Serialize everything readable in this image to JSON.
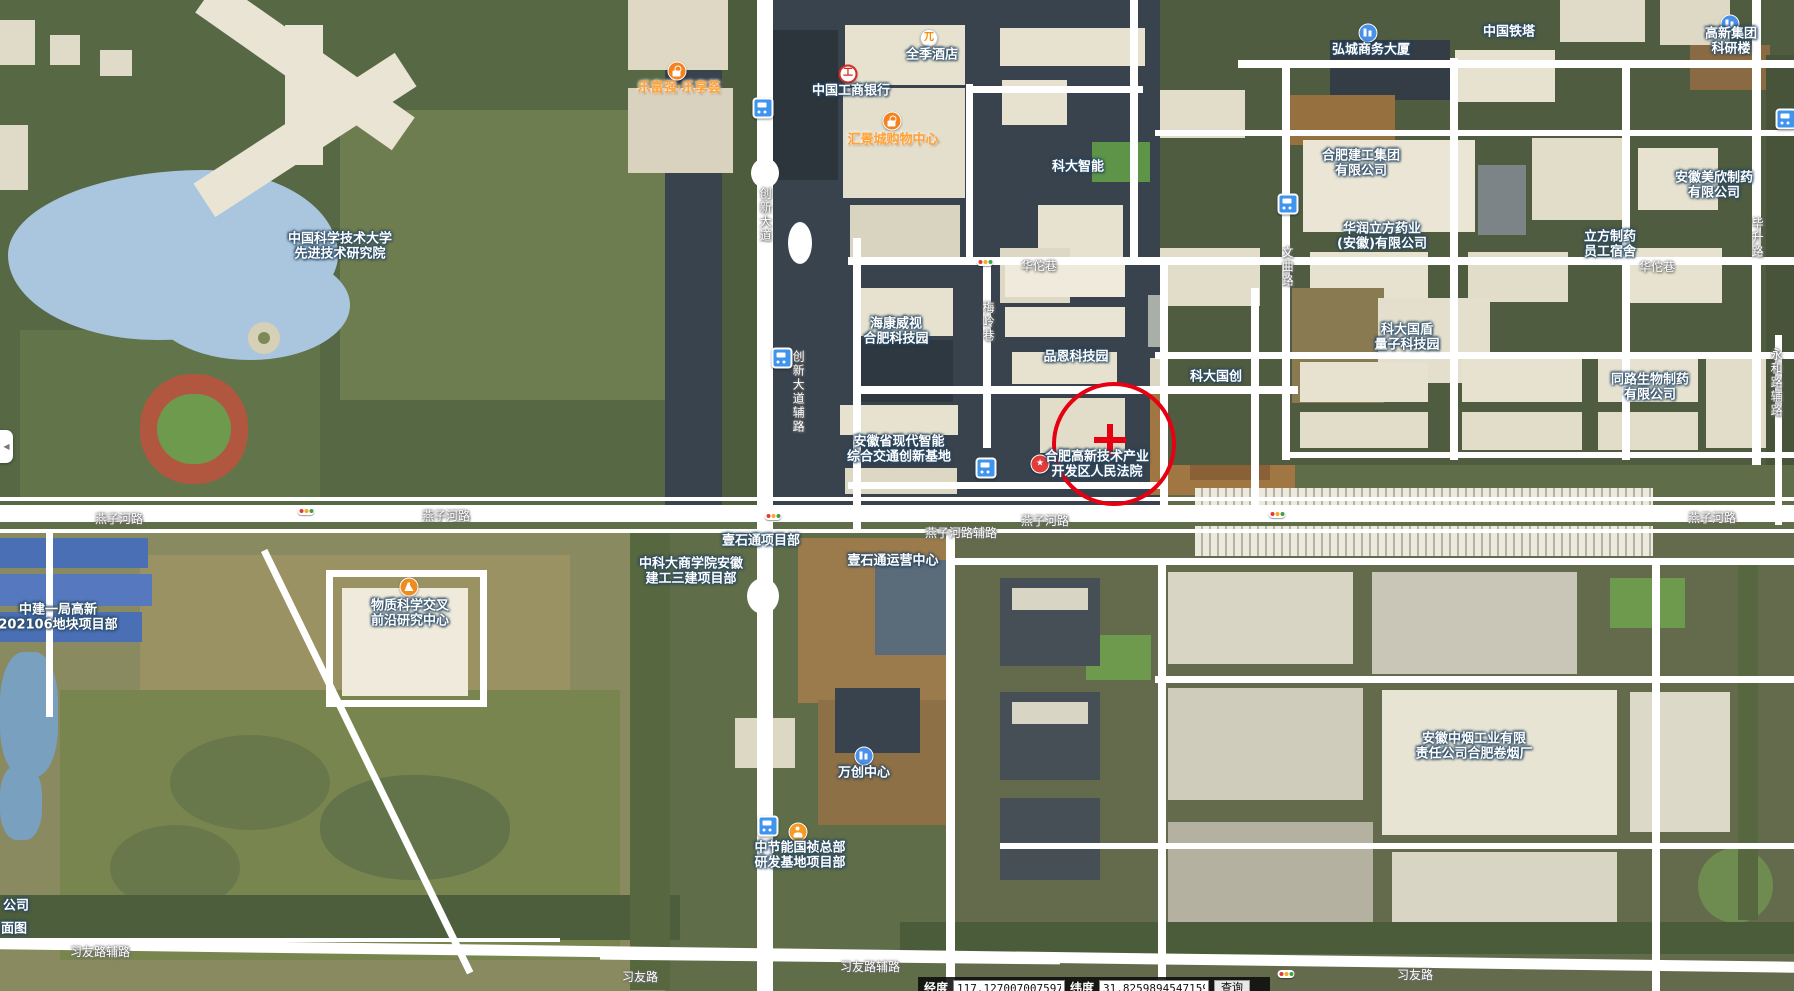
{
  "map": {
    "marker": {
      "x": 1110,
      "y": 440,
      "r": 58,
      "color": "#e60012"
    },
    "labels": [
      {
        "text": "中国科学技术大学\n先进技术研究院",
        "x": 340,
        "y": 247,
        "kind": "poi"
      },
      {
        "text": "乐富强·乐享荟",
        "x": 679,
        "y": 88,
        "kind": "orange"
      },
      {
        "text": "全季酒店",
        "x": 932,
        "y": 55,
        "kind": "poi"
      },
      {
        "text": "中国工商银行",
        "x": 851,
        "y": 91,
        "kind": "poi"
      },
      {
        "text": "汇景城购物中心",
        "x": 893,
        "y": 140,
        "kind": "orange"
      },
      {
        "text": "科大智能",
        "x": 1078,
        "y": 167,
        "kind": "poi"
      },
      {
        "text": "中国铁塔",
        "x": 1509,
        "y": 32,
        "kind": "poi"
      },
      {
        "text": "弘城商务大厦",
        "x": 1371,
        "y": 50,
        "kind": "poi"
      },
      {
        "text": "高新集团科研楼",
        "x": 1731,
        "y": 42,
        "kind": "poi"
      },
      {
        "text": "合肥建工集团\n有限公司",
        "x": 1361,
        "y": 164,
        "kind": "poi"
      },
      {
        "text": "华润立方药业\n(安徽)有限公司",
        "x": 1382,
        "y": 237,
        "kind": "poi"
      },
      {
        "text": "安徽美欣制药\n有限公司",
        "x": 1714,
        "y": 186,
        "kind": "poi"
      },
      {
        "text": "立方制药\n员工宿舍",
        "x": 1610,
        "y": 245,
        "kind": "poi"
      },
      {
        "text": "海康威视\n合肥科技园",
        "x": 896,
        "y": 332,
        "kind": "poi"
      },
      {
        "text": "品恩科技园",
        "x": 1076,
        "y": 357,
        "kind": "poi"
      },
      {
        "text": "科大国创",
        "x": 1216,
        "y": 377,
        "kind": "poi"
      },
      {
        "text": "科大国盾\n量子科技园",
        "x": 1407,
        "y": 338,
        "kind": "poi"
      },
      {
        "text": "同路生物制药\n有限公司",
        "x": 1650,
        "y": 388,
        "kind": "poi"
      },
      {
        "text": "安徽省现代智能\n综合交通创新基地",
        "x": 899,
        "y": 450,
        "kind": "poi"
      },
      {
        "text": "合肥高新技术产业\n开发区人民法院",
        "x": 1097,
        "y": 465,
        "kind": "poi"
      },
      {
        "text": "物质科学交叉\n前沿研究中心",
        "x": 410,
        "y": 614,
        "kind": "poi"
      },
      {
        "text": "中科大商学院安徽\n建工三建项目部",
        "x": 691,
        "y": 572,
        "kind": "poi"
      },
      {
        "text": "壹石通项目部",
        "x": 761,
        "y": 541,
        "kind": "poi"
      },
      {
        "text": "壹石通运营中心",
        "x": 893,
        "y": 561,
        "kind": "poi"
      },
      {
        "text": "万创中心",
        "x": 864,
        "y": 773,
        "kind": "poi"
      },
      {
        "text": "中节能国祯总部\n研发基地项目部",
        "x": 800,
        "y": 856,
        "kind": "poi"
      },
      {
        "text": "安徽中烟工业有限\n责任公司合肥卷烟厂",
        "x": 1474,
        "y": 747,
        "kind": "poi"
      },
      {
        "text": "中建一局高新\n202106地块项目部",
        "x": 58,
        "y": 618,
        "kind": "poi"
      },
      {
        "text": "公司",
        "x": 16,
        "y": 906,
        "kind": "poi"
      },
      {
        "text": "面图",
        "x": 14,
        "y": 929,
        "kind": "poi"
      },
      {
        "text": "燕子河路",
        "x": 119,
        "y": 519,
        "kind": "road"
      },
      {
        "text": "燕子河路",
        "x": 446,
        "y": 516,
        "kind": "road"
      },
      {
        "text": "燕子河路",
        "x": 1045,
        "y": 521,
        "kind": "road"
      },
      {
        "text": "燕子河路",
        "x": 1712,
        "y": 518,
        "kind": "road"
      },
      {
        "text": "燕子河路辅路",
        "x": 961,
        "y": 533,
        "kind": "road"
      },
      {
        "text": "习友路辅路",
        "x": 100,
        "y": 952,
        "kind": "road"
      },
      {
        "text": "习友路",
        "x": 640,
        "y": 977,
        "kind": "road"
      },
      {
        "text": "习友路辅路",
        "x": 870,
        "y": 967,
        "kind": "road"
      },
      {
        "text": "习友路",
        "x": 1415,
        "y": 975,
        "kind": "road"
      },
      {
        "text": "华佗巷",
        "x": 1039,
        "y": 266,
        "kind": "road"
      },
      {
        "text": "华佗巷",
        "x": 1657,
        "y": 267,
        "kind": "road"
      },
      {
        "text": "创新大道",
        "x": 765,
        "y": 215,
        "kind": "road-v"
      },
      {
        "text": "创新大道辅路",
        "x": 798,
        "y": 392,
        "kind": "road-v"
      },
      {
        "text": "梅岭巷",
        "x": 988,
        "y": 322,
        "kind": "road-v"
      },
      {
        "text": "文曲路",
        "x": 1287,
        "y": 267,
        "kind": "road-v"
      },
      {
        "text": "毕升路",
        "x": 1757,
        "y": 238,
        "kind": "road-v"
      },
      {
        "text": "永和路辅路",
        "x": 1776,
        "y": 383,
        "kind": "road-v"
      }
    ],
    "icons": [
      {
        "type": "bag",
        "name": "shopping-bag-icon",
        "x": 677,
        "y": 71
      },
      {
        "type": "hotel",
        "name": "hotel-icon",
        "x": 929,
        "y": 38,
        "glyph": "兀"
      },
      {
        "type": "icbc",
        "name": "bank-icbc-icon",
        "x": 848,
        "y": 74,
        "glyph": "工"
      },
      {
        "type": "bag",
        "name": "shopping-bag-icon",
        "x": 892,
        "y": 121
      },
      {
        "type": "building",
        "name": "office-building-icon",
        "x": 1368,
        "y": 33
      },
      {
        "type": "building",
        "name": "office-building-icon",
        "x": 1730,
        "y": 24
      },
      {
        "type": "building",
        "name": "office-building-icon",
        "x": 864,
        "y": 756
      },
      {
        "type": "court",
        "name": "court-star-icon",
        "x": 1040,
        "y": 464,
        "glyph": "★"
      },
      {
        "type": "constr",
        "name": "construction-worker-icon",
        "x": 798,
        "y": 832
      },
      {
        "type": "flask",
        "name": "research-flask-icon",
        "x": 409,
        "y": 587
      },
      {
        "type": "bus",
        "name": "bus-stop-icon",
        "x": 763,
        "y": 108
      },
      {
        "type": "bus",
        "name": "bus-stop-icon",
        "x": 782,
        "y": 358
      },
      {
        "type": "bus",
        "name": "bus-stop-icon",
        "x": 986,
        "y": 468
      },
      {
        "type": "bus",
        "name": "bus-stop-icon",
        "x": 1288,
        "y": 204
      },
      {
        "type": "bus",
        "name": "bus-stop-icon",
        "x": 1786,
        "y": 119
      },
      {
        "type": "bus",
        "name": "bus-stop-icon",
        "x": 768,
        "y": 826
      },
      {
        "type": "light",
        "name": "traffic-light-icon",
        "x": 985,
        "y": 262
      },
      {
        "type": "light",
        "name": "traffic-light-icon",
        "x": 306,
        "y": 511
      },
      {
        "type": "light",
        "name": "traffic-light-icon",
        "x": 773,
        "y": 516
      },
      {
        "type": "light",
        "name": "traffic-light-icon",
        "x": 1277,
        "y": 514
      },
      {
        "type": "light",
        "name": "traffic-light-icon",
        "x": 1286,
        "y": 974
      }
    ],
    "collapse_arrow": "◀"
  },
  "coordbar": {
    "lng_label": "经度",
    "lng_value": "117.127007007597",
    "lat_label": "纬度",
    "lat_value": "31.82598945471594",
    "search_label": "查询"
  }
}
